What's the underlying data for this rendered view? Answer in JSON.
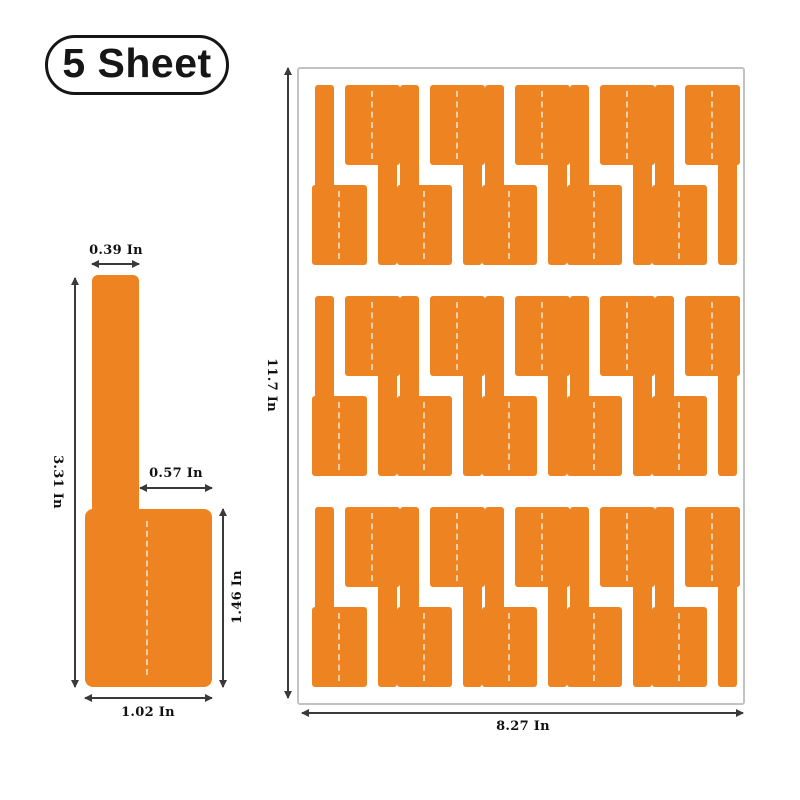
{
  "badge": {
    "label": "5 Sheet"
  },
  "colors": {
    "label_orange": "#EE8421",
    "fold_line": "rgba(255,255,255,0.6)",
    "dim_line": "#3a3a3a",
    "text": "#111111",
    "sheet_border": "#c2c2c2"
  },
  "label_diagram": {
    "top_width": "0.39 In",
    "total_height": "3.31 In",
    "notch_width": "0.57 In",
    "flag_height": "1.46 In",
    "flag_width": "1.02 In"
  },
  "sheet_diagram": {
    "sheet_height": "11.7 In",
    "sheet_width": "8.27 In",
    "rows": 3,
    "labels_per_row": 10
  }
}
